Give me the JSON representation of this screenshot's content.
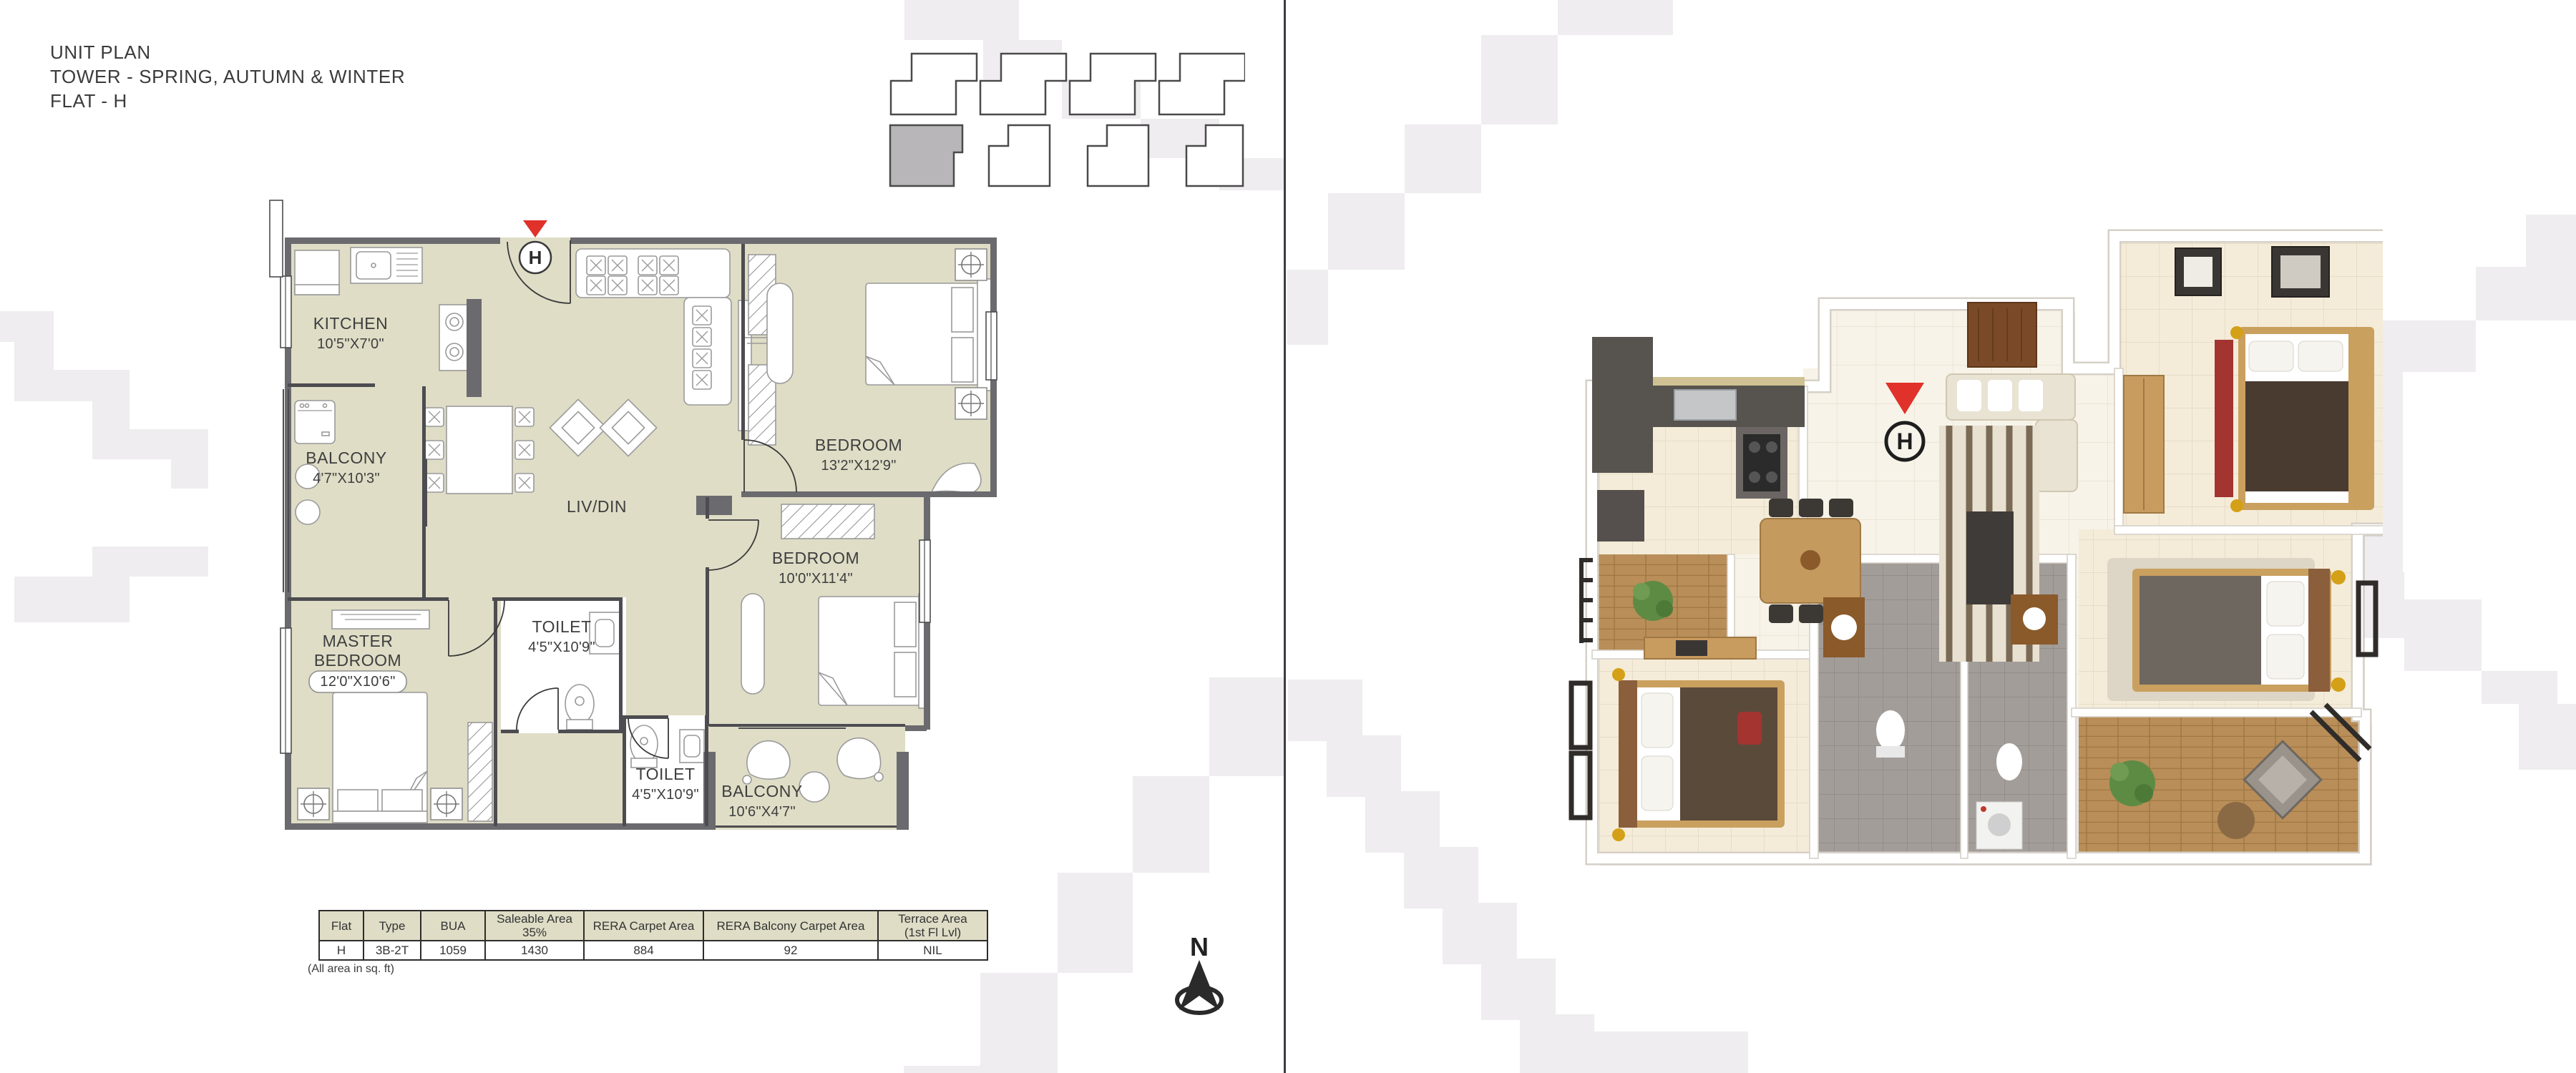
{
  "title": {
    "lines": [
      "UNIT PLAN",
      "TOWER - SPRING, AUTUMN & WINTER",
      "FLAT - H"
    ]
  },
  "key_plan": {
    "highlighted_unit": "H"
  },
  "floorplan_2d": {
    "entry_marker": "H",
    "rooms": {
      "kitchen": {
        "name": "KITCHEN",
        "dims": "10'5\"X7'0\""
      },
      "balcony_left": {
        "name": "BALCONY",
        "dims": "4'7\"X10'3\""
      },
      "livdin": {
        "name": "LIV/DIN"
      },
      "bedroom_top": {
        "name": "BEDROOM",
        "dims": "13'2\"X12'9\""
      },
      "bedroom_mid": {
        "name": "BEDROOM",
        "dims": "10'0\"X11'4\""
      },
      "master_bedroom": {
        "name_line1": "MASTER",
        "name_line2": "BEDROOM",
        "dims": "12'0\"X10'6\""
      },
      "toilet_mid": {
        "name": "TOILET",
        "dims": "4'5\"X10'9\""
      },
      "toilet_bottom": {
        "name": "TOILET",
        "dims": "4'5\"X10'9\""
      },
      "balcony_bottom": {
        "name": "BALCONY",
        "dims": "10'6\"X4'7\""
      }
    }
  },
  "plan_3d": {
    "entry_marker": "H"
  },
  "area_table": {
    "headers": [
      {
        "line1": "Flat",
        "line2": ""
      },
      {
        "line1": "Type",
        "line2": ""
      },
      {
        "line1": "BUA",
        "line2": ""
      },
      {
        "line1": "Saleable Area",
        "line2": "35%"
      },
      {
        "line1": "RERA Carpet Area",
        "line2": ""
      },
      {
        "line1": "RERA Balcony Carpet Area",
        "line2": ""
      },
      {
        "line1": "Terrace Area",
        "line2": "(1st Fl Lvl)"
      }
    ],
    "row": [
      "H",
      "3B-2T",
      "1059",
      "1430",
      "884",
      "92",
      "NIL"
    ],
    "note": "(All area in sq. ft)"
  },
  "compass": {
    "label": "N"
  },
  "colors": {
    "plan_floor": "#dfddc6",
    "wall_dark": "#6b6a6e",
    "accent_red": "#e0312a",
    "step_gray": "#efedef",
    "table_header_bg": "#dfddc6"
  }
}
